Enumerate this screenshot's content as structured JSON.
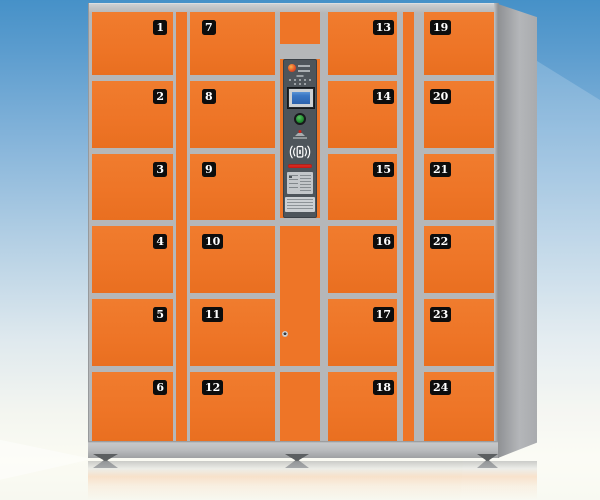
{
  "locker": {
    "columns": [
      {
        "name": "column-1",
        "badge_side": "right",
        "doors": [
          "1",
          "2",
          "3",
          "4",
          "5",
          "6"
        ]
      },
      {
        "name": "column-2",
        "badge_side": "left",
        "doors": [
          "7",
          "8",
          "9",
          "10",
          "11",
          "12"
        ]
      },
      {
        "name": "column-3",
        "badge_side": "right",
        "doors": [
          "13",
          "14",
          "15",
          "16",
          "17",
          "18"
        ]
      },
      {
        "name": "column-4",
        "badge_side": "left",
        "doors": [
          "19",
          "20",
          "21",
          "22",
          "23",
          "24"
        ]
      }
    ],
    "control_panel": {
      "icons": {
        "logo": "brand-logo-icon",
        "speaker": "speaker-holes",
        "screen": "lcd-screen",
        "button": "power-button",
        "receipt": "receipt-outlet-icon",
        "rfid": "contactless-card-reader-icon",
        "card_slot": "card-swipe-slot",
        "instructions": "instruction-label",
        "spec": "spec-label"
      }
    }
  },
  "colors": {
    "door_orange": "#ee7527",
    "frame_gray": "#b5b7b9",
    "panel_gray": "#4e555b",
    "screen_blue": "#2f6cb8",
    "button_green": "#2f9e3c",
    "slot_red": "#e8251d",
    "background_blue": "#4691c8"
  }
}
